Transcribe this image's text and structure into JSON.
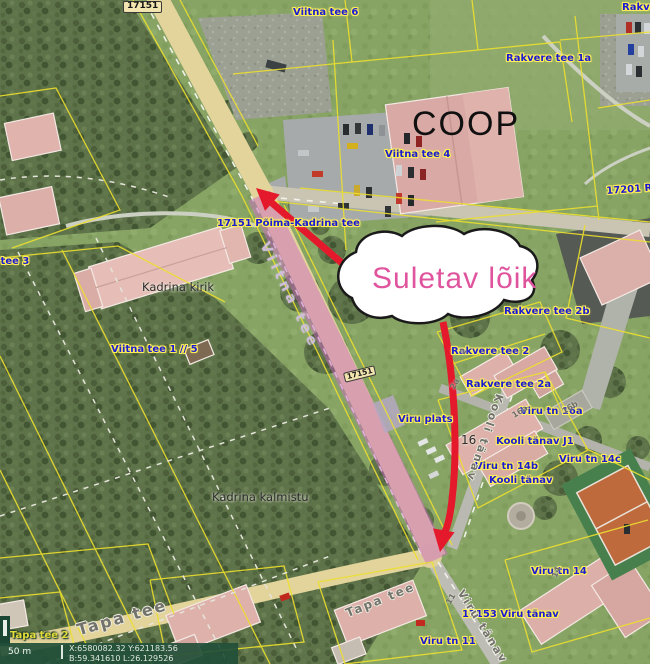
{
  "annotations": {
    "closure_label": "Suletav lõik"
  },
  "map_labels": {
    "badge_17151_top": "17151",
    "badge_17151_mid": "17151",
    "viitna_tee_6": "Viitna tee 6",
    "rakvere_tee_corner": "Rakvere tee",
    "rakvere_tee_1a": "Rakvere tee 1a",
    "viitna_tee_4": "Viitna tee 4",
    "coop": "COOP",
    "rakvere_tee_17201": "17201 Rakvere tee",
    "pohja_kadrina_tee": "17151 Põima-Kadrina tee",
    "kadrina_kirik": "Kadrina kirik",
    "viitna_tee_3": "Viitna tee 3",
    "viitna_tee_1_5": "Viitna tee 1 // 5",
    "rakvere_tee_2b": "Rakvere tee 2b",
    "rakvere_tee_2": "Rakvere tee 2",
    "rakvere_tee_2a": "Rakvere tee 2a",
    "viru_plats": "Viru plats",
    "viru_tn_16a": "Viru tn 16a",
    "kooli_tanav_j1": "Kooli tänav J1",
    "bldg_16": "16",
    "viru_tn_14b": "Viru tn 14b",
    "kooli_tanav": "Kooli tänav",
    "viru_tn_14c": "Viru tn 14c",
    "viru_tn_14": "Viru tn 14",
    "viru_tanav_17153": "17153 Viru tänav",
    "viru_tn_11": "Viru tn 11",
    "tapa_tee_2": "Tapa tee 2",
    "kadrina_kalmistu": "Kadrina kalmistu",
    "num_2": "2",
    "num_2a": "2a",
    "num_16a": "16a",
    "num_16b": "16b",
    "num_14": "14",
    "num_11": "11"
  },
  "road_names": {
    "viitna_tee": "Viitna tee",
    "kooli_tanav": "Kooli tänav",
    "tapa_tee": "Tapa tee",
    "tapa_tee_2nd": "Tapa tee",
    "viru_tanav": "Viru tänav"
  },
  "status_bar": {
    "scale": "50 m",
    "coords_xy": "X:6580082.32 Y:621183.56",
    "coords_bl": "B:59.341610 L:26.129526"
  },
  "colors": {
    "closure_highlight": "#cd6bc4",
    "arrow_red": "#e4192c",
    "closure_text_pink": "#e0549e",
    "cadastral_yellow": "#ecdf2e",
    "address_blue": "#1b1bd1",
    "road_beige": "#e3d49b"
  }
}
